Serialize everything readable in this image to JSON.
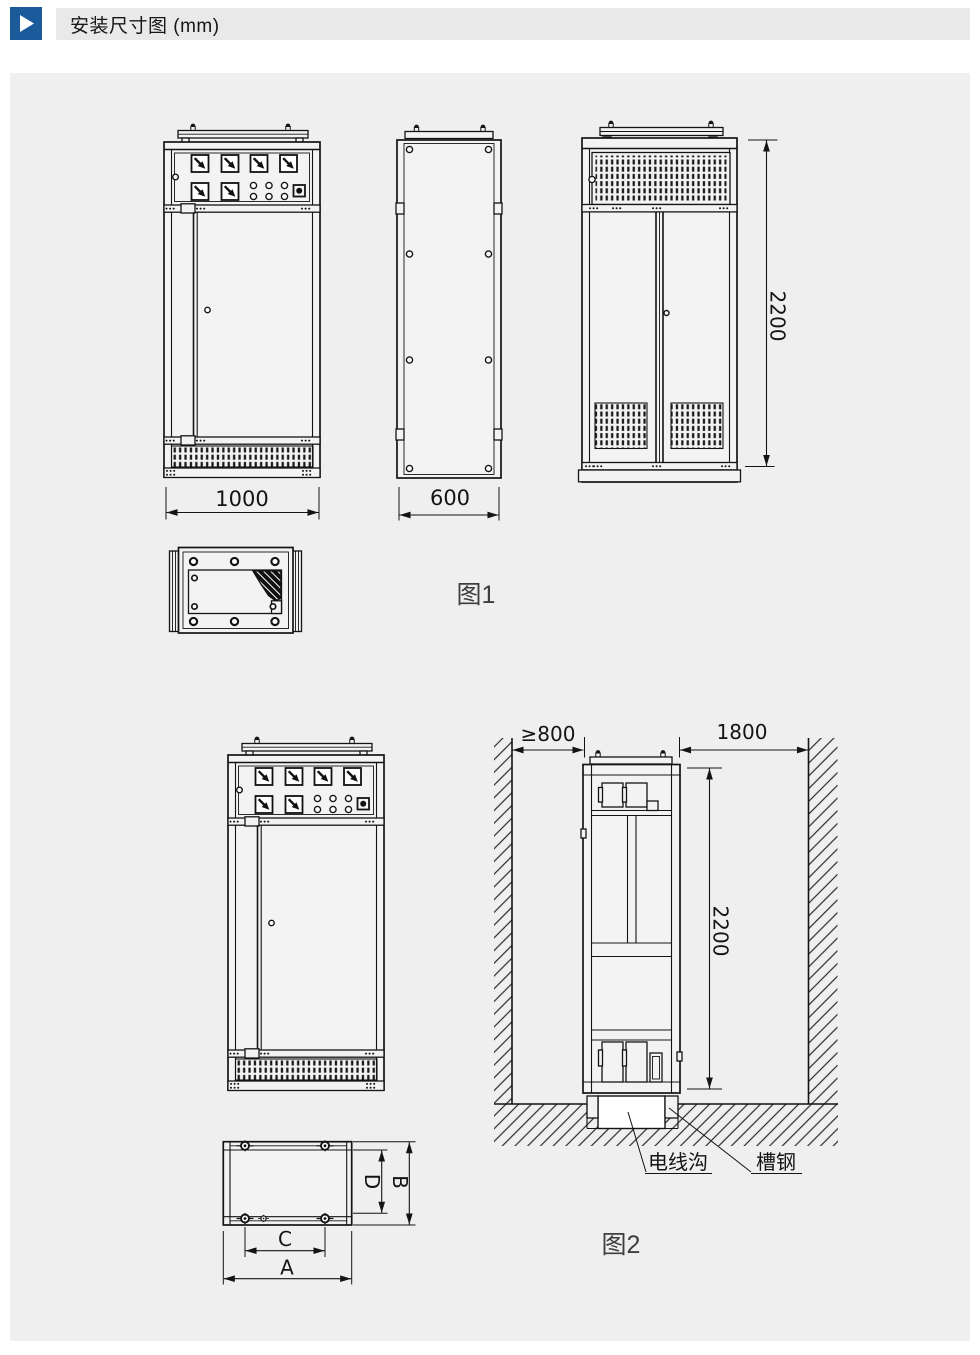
{
  "header": {
    "title": "安装尺寸图 (mm)"
  },
  "figure1": {
    "caption": "图1",
    "dims": {
      "width": "1000",
      "depth": "600",
      "height": "2200"
    }
  },
  "figure2": {
    "caption": "图2",
    "dims": {
      "left_clearance": "≥800",
      "right_clearance": "1800",
      "height": "2200",
      "base_outer_width": "A",
      "base_outer_depth": "B",
      "base_bolt_span": "C",
      "base_inner_depth": "D"
    },
    "labels": {
      "wire_trench": "电线沟",
      "channel_steel": "槽钢"
    }
  },
  "icons": {
    "section_marker": "play-triangle"
  },
  "colors": {
    "accent_blue": "#1b5a9b",
    "header_bar": "#e9e9e9",
    "panel_background": "#efefef",
    "line": "#141414"
  }
}
